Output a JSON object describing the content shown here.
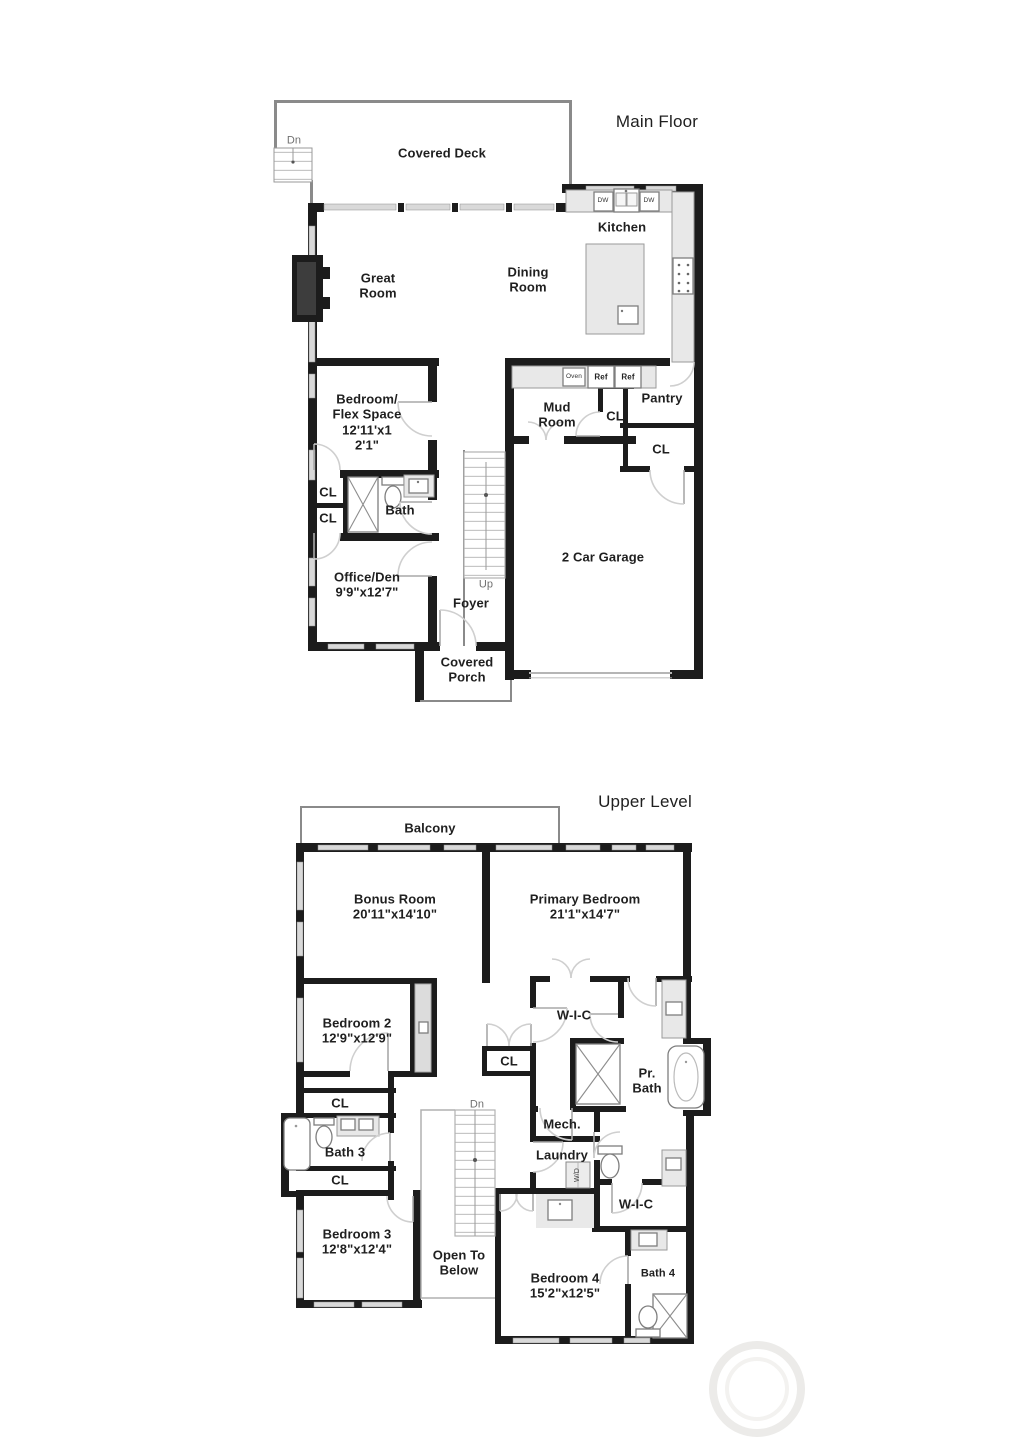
{
  "colors": {
    "bg": "#ffffff",
    "wall": "#1c1c1c",
    "thin": "#8a8a8a",
    "window": "#d9d9d9",
    "counter": "#e8e8e8",
    "counterBorder": "#9a9a9a",
    "door": "#cfcfcf",
    "text": "#1f1f1f",
    "muted": "#707070",
    "watermark": "#ecebe9"
  },
  "main_floor": {
    "title": "Main Floor",
    "labels": {
      "covered_deck": "Covered Deck",
      "deck_stairs": "Dn",
      "great_room": "Great\nRoom",
      "dining_room": "Dining\nRoom",
      "kitchen": "Kitchen",
      "dw1": "DW",
      "dw2": "DW",
      "oven": "Oven",
      "ref1": "Ref",
      "ref2": "Ref",
      "mud_room": "Mud\nRoom",
      "cl_mud": "CL",
      "pantry": "Pantry",
      "cl_pantry": "CL",
      "bedroom_flex": "Bedroom/\nFlex Space\n12'11'x1\n2'1\"",
      "cl_hall_upper": "CL",
      "cl_hall_lower": "CL",
      "bath": "Bath",
      "office_den": "Office/Den\n9'9\"x12'7\"",
      "stairs_up": "Up",
      "foyer": "Foyer",
      "garage": "2 Car Garage",
      "covered_porch": "Covered\nPorch"
    }
  },
  "upper_level": {
    "title": "Upper Level",
    "labels": {
      "balcony": "Balcony",
      "bonus_room": "Bonus Room\n20'11\"x14'10\"",
      "primary_bedroom": "Primary Bedroom\n21'1\"x14'7\"",
      "bedroom2": "Bedroom 2\n12'9\"x12'9\"",
      "cl_hall": "CL",
      "wic1": "W-I-C",
      "pr_bath": "Pr.\nBath",
      "mech": "Mech.",
      "laundry": "Laundry",
      "washer_dryer": "W/D",
      "cl_bath3_top": "CL",
      "bath3": "Bath 3",
      "cl_bath3_bottom": "CL",
      "bedroom3": "Bedroom 3\n12'8\"x12'4\"",
      "open_to_below": "Open To\nBelow",
      "stairs_dn": "Dn",
      "bedroom4": "Bedroom 4\n15'2\"x12'5\"",
      "wic2": "W-I-C",
      "bath4": "Bath 4"
    }
  }
}
